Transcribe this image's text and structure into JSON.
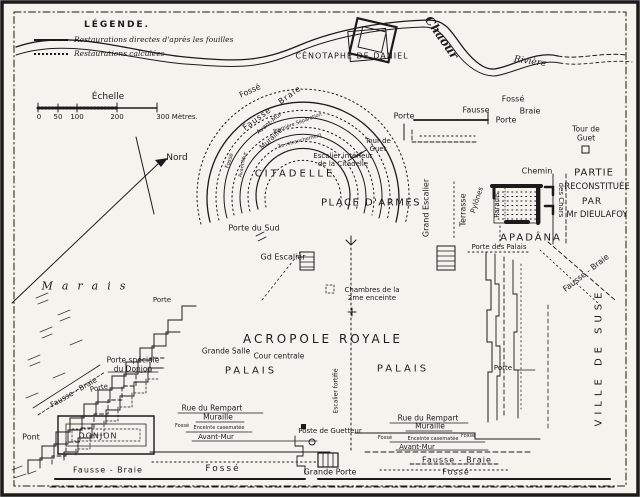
{
  "colors": {
    "ink": "#1b1b1b",
    "paper": "#f5f3ee"
  },
  "legend": {
    "title": "LÉGENDE.",
    "items": [
      {
        "sample": "solid",
        "label": "Restaurations directes d'après les fouilles"
      },
      {
        "sample": "dotted",
        "label": "Restaurations calculées"
      }
    ]
  },
  "labels": [
    {
      "id": "scale-title",
      "text": "Échelle",
      "x": 108,
      "y": 97,
      "fs": 9
    },
    {
      "id": "scale-tick-0",
      "text": "0",
      "x": 39,
      "y": 117,
      "fs": 7
    },
    {
      "id": "scale-tick-50",
      "text": "50",
      "x": 58,
      "y": 117,
      "fs": 7
    },
    {
      "id": "scale-tick-100",
      "text": "100",
      "x": 77,
      "y": 117,
      "fs": 7
    },
    {
      "id": "scale-tick-200",
      "text": "200",
      "x": 117,
      "y": 117,
      "fs": 7
    },
    {
      "id": "scale-tick-300",
      "text": "300 Mètres.",
      "x": 177,
      "y": 117,
      "fs": 7
    },
    {
      "id": "north-label",
      "text": "Nord",
      "x": 177,
      "y": 158,
      "fs": 9
    },
    {
      "id": "cenotaph-label",
      "text": "CÉNOTAPHE DE DANIEL",
      "x": 352,
      "y": 56,
      "fs": 8,
      "ls": 1
    },
    {
      "id": "river-name-chaour",
      "text": "Chaour",
      "x": 441,
      "y": 38,
      "fs": 12,
      "rot": 55,
      "cls": "script bold"
    },
    {
      "id": "river-name-riviere",
      "text": "Rivière",
      "x": 530,
      "y": 62,
      "fs": 9,
      "rot": 8,
      "cls": "script"
    },
    {
      "id": "citadel-fosse",
      "text": "Fossé",
      "x": 250,
      "y": 91,
      "fs": 8,
      "rot": -25
    },
    {
      "id": "citadel-fausse-braie",
      "text": "Fausse - Braie",
      "x": 272,
      "y": 108,
      "fs": 8,
      "rot": -36,
      "ls": 1
    },
    {
      "id": "citadel-avant-mur",
      "text": "Avant-Mur",
      "x": 270,
      "y": 124,
      "fs": 6,
      "rot": -40
    },
    {
      "id": "citadel-premiere-separation",
      "text": "Première Séparation",
      "x": 298,
      "y": 124,
      "fs": 5,
      "rot": -20
    },
    {
      "id": "citadel-muraille",
      "text": "Muraille",
      "x": 271,
      "y": 139,
      "fs": 7,
      "rot": -43
    },
    {
      "id": "citadel-retranchement",
      "text": "2e retranchement",
      "x": 300,
      "y": 142,
      "fs": 5,
      "rot": -15
    },
    {
      "id": "citadel-fosse-west",
      "text": "Fossé",
      "x": 230,
      "y": 161,
      "fs": 5.5,
      "rot": -72
    },
    {
      "id": "citadel-avant-mur-west",
      "text": "Avant-Mur",
      "x": 244,
      "y": 165,
      "fs": 5,
      "rot": -78
    },
    {
      "id": "citadel-tour-de-guet",
      "text": "Tour de\nGuet",
      "x": 378,
      "y": 145,
      "fs": 7
    },
    {
      "id": "citadel-escalier-interieur",
      "text": "Escalier intérieur\nde la Citadelle",
      "x": 343,
      "y": 160,
      "fs": 7
    },
    {
      "id": "citadelle-title",
      "text": "CITADELLE",
      "x": 295,
      "y": 174,
      "fs": 10,
      "ls": 3
    },
    {
      "id": "place-darmes",
      "text": "PLACE D'ARMES",
      "x": 371,
      "y": 203,
      "fs": 10,
      "ls": 1.5
    },
    {
      "id": "porte-du-sud",
      "text": "Porte du Sud",
      "x": 254,
      "y": 228,
      "fs": 8
    },
    {
      "id": "gd-escalier",
      "text": "Gd Escalier",
      "x": 283,
      "y": 257,
      "fs": 8
    },
    {
      "id": "chambres-2e-enceinte",
      "text": "Chambres de la\n2me enceinte",
      "x": 372,
      "y": 294,
      "fs": 7
    },
    {
      "id": "grand-escalier-vertical",
      "text": "Grand Escalier",
      "x": 426,
      "y": 208,
      "fs": 8,
      "rot": -90
    },
    {
      "id": "terrasse",
      "text": "Terrasse",
      "x": 463,
      "y": 210,
      "fs": 8,
      "rot": -90
    },
    {
      "id": "pylones",
      "text": "Pylônes",
      "x": 477,
      "y": 200,
      "fs": 7,
      "rot": -72
    },
    {
      "id": "porte-des-palais",
      "text": "Porte des Palais",
      "x": 499,
      "y": 247,
      "fs": 7
    },
    {
      "id": "chemin",
      "text": "Chemin",
      "x": 537,
      "y": 171,
      "fs": 8
    },
    {
      "id": "des-chars",
      "text": "des Chars",
      "x": 561,
      "y": 200,
      "fs": 7,
      "rot": 90
    },
    {
      "id": "partie-line1",
      "text": "PARTIE",
      "x": 594,
      "y": 173,
      "fs": 10,
      "ls": 1
    },
    {
      "id": "partie-line2",
      "text": "RECONSTITUÉE",
      "x": 597,
      "y": 188,
      "fs": 8.5
    },
    {
      "id": "partie-line3",
      "text": "PAR",
      "x": 592,
      "y": 202,
      "fs": 9,
      "ls": 1
    },
    {
      "id": "partie-line4",
      "text": "Mr DIEULAFOY",
      "x": 597,
      "y": 216,
      "fs": 8.5
    },
    {
      "id": "paradis",
      "text": "Paradis",
      "x": 497,
      "y": 205,
      "fs": 7,
      "rot": -90
    },
    {
      "id": "apadana-title",
      "text": "APADÂNA",
      "x": 531,
      "y": 238,
      "fs": 10,
      "ls": 2
    },
    {
      "id": "fausse-braie-ne",
      "text": "Fausse - Braie",
      "x": 586,
      "y": 273,
      "fs": 8,
      "rot": -38
    },
    {
      "id": "porte-nw",
      "text": "Porte",
      "x": 404,
      "y": 116,
      "fs": 8
    },
    {
      "id": "fosse-north",
      "text": "Fossé",
      "x": 513,
      "y": 99,
      "fs": 8
    },
    {
      "id": "fausse-north",
      "text": "Fausse",
      "x": 476,
      "y": 110,
      "fs": 8
    },
    {
      "id": "braie-north",
      "text": "Braie",
      "x": 530,
      "y": 111,
      "fs": 8
    },
    {
      "id": "porte-north",
      "text": "Porte",
      "x": 506,
      "y": 120,
      "fs": 8
    },
    {
      "id": "tour-de-guet-ne",
      "text": "Tour de\nGuet",
      "x": 586,
      "y": 134,
      "fs": 7.5
    },
    {
      "id": "marais",
      "text": "Marais",
      "x": 88,
      "y": 287,
      "fs": 11,
      "ls": 9,
      "cls": "script"
    },
    {
      "id": "porte-west",
      "text": "Porte",
      "x": 162,
      "y": 300,
      "fs": 7
    },
    {
      "id": "porte-speciale-donjon",
      "text": "Porte spéciale\ndu Donjon",
      "x": 133,
      "y": 365,
      "fs": 7.5
    },
    {
      "id": "fausse-braie-sw",
      "text": "Fausse - Braie",
      "x": 74,
      "y": 393,
      "fs": 7.5,
      "rot": -30
    },
    {
      "id": "porte-sw",
      "text": "Porte",
      "x": 99,
      "y": 388,
      "fs": 7,
      "rot": -12
    },
    {
      "id": "pont",
      "text": "Pont",
      "x": 31,
      "y": 437,
      "fs": 8
    },
    {
      "id": "donjon",
      "text": "DONJON",
      "x": 98,
      "y": 436,
      "fs": 8,
      "ls": 1
    },
    {
      "id": "fausse-braie-south1",
      "text": "Fausse - Braie",
      "x": 108,
      "y": 470,
      "fs": 8,
      "ls": 1
    },
    {
      "id": "fosse-south1",
      "text": "Fossé",
      "x": 223,
      "y": 469,
      "fs": 9,
      "ls": 2
    },
    {
      "id": "rue-du-rempart-1",
      "text": "Rue du Rempart",
      "x": 212,
      "y": 409,
      "fs": 7.5
    },
    {
      "id": "muraille-1",
      "text": "Muraille",
      "x": 218,
      "y": 418,
      "fs": 7.5
    },
    {
      "id": "fosse-small-1",
      "text": "Fossé",
      "x": 182,
      "y": 427,
      "fs": 5
    },
    {
      "id": "enceinte-casematee-1",
      "text": "Enceinte casematée",
      "x": 219,
      "y": 429,
      "fs": 5
    },
    {
      "id": "avant-mur-1",
      "text": "Avant-Mur",
      "x": 216,
      "y": 437,
      "fs": 7
    },
    {
      "id": "escalier-fortifie",
      "text": "Escalier fortifié",
      "x": 337,
      "y": 391,
      "fs": 6,
      "rot": -90
    },
    {
      "id": "poste-de-guetteur",
      "text": "Poste de Guetteur",
      "x": 330,
      "y": 431,
      "fs": 7
    },
    {
      "id": "grande-porte",
      "text": "Grande Porte",
      "x": 330,
      "y": 472,
      "fs": 8
    },
    {
      "id": "rue-du-rempart-2",
      "text": "Rue du Rempart",
      "x": 428,
      "y": 419,
      "fs": 7.5
    },
    {
      "id": "muraille-2",
      "text": "Muraille",
      "x": 430,
      "y": 427,
      "fs": 7.5
    },
    {
      "id": "fosse-small-2a",
      "text": "Fossé",
      "x": 385,
      "y": 439,
      "fs": 5
    },
    {
      "id": "enceinte-casematee-2",
      "text": "Enceinte casematée",
      "x": 433,
      "y": 440,
      "fs": 5
    },
    {
      "id": "fosse-small-2b",
      "text": "Fossé",
      "x": 468,
      "y": 437,
      "fs": 5
    },
    {
      "id": "avant-mur-2",
      "text": "Avant-Mur",
      "x": 417,
      "y": 447,
      "fs": 7
    },
    {
      "id": "fausse-braie-south2",
      "text": "Fausse - Braie",
      "x": 457,
      "y": 460,
      "fs": 8,
      "ls": 1
    },
    {
      "id": "fosse-south2",
      "text": "Fossé",
      "x": 456,
      "y": 472,
      "fs": 8,
      "ls": 1
    },
    {
      "id": "porte-east",
      "text": "Porte",
      "x": 503,
      "y": 368,
      "fs": 7
    },
    {
      "id": "ville-de-suse",
      "text": "VILLE DE SUSE",
      "x": 599,
      "y": 357,
      "fs": 10,
      "rot": -90,
      "ls": 5
    },
    {
      "id": "acropole-royale",
      "text": "ACROPOLE ROYALE",
      "x": 323,
      "y": 340,
      "fs": 12,
      "ls": 3
    },
    {
      "id": "grande-salle",
      "text": "Grande Salle",
      "x": 226,
      "y": 352,
      "fs": 7.5
    },
    {
      "id": "cour-centrale",
      "text": "Cour centrale",
      "x": 279,
      "y": 357,
      "fs": 7.5
    },
    {
      "id": "palais-west",
      "text": "PALAIS",
      "x": 251,
      "y": 371,
      "fs": 10,
      "ls": 3
    },
    {
      "id": "palais-east",
      "text": "PALAIS",
      "x": 403,
      "y": 369,
      "fs": 10,
      "ls": 3
    }
  ]
}
